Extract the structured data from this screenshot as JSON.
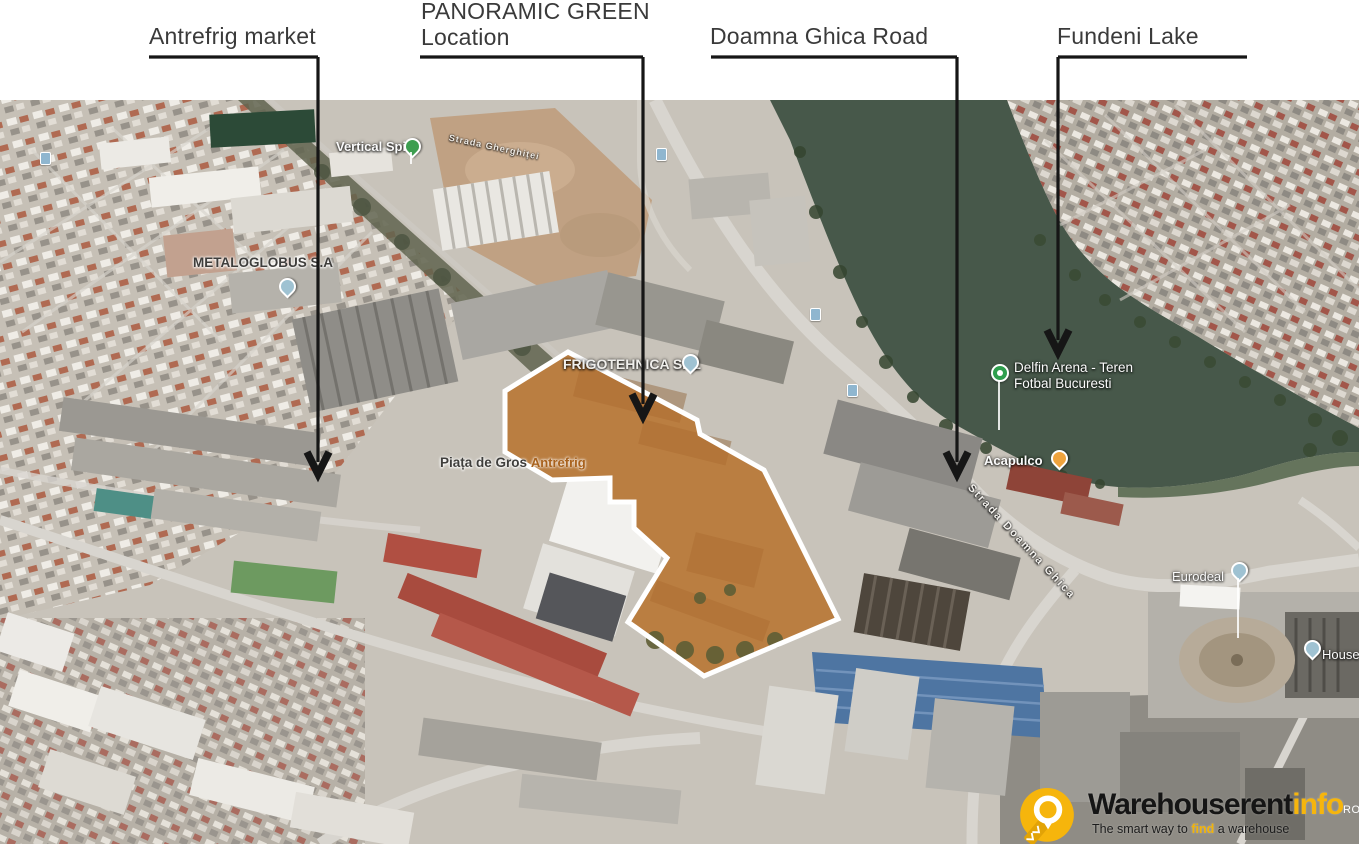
{
  "callouts": {
    "antrefrig": {
      "label": "Antrefrig market"
    },
    "panoramic": {
      "line1": "PANORAMIC GREEN",
      "line2": "Location"
    },
    "doamna": {
      "label": "Doamna Ghica Road"
    },
    "fundeni": {
      "label": "Fundeni Lake"
    }
  },
  "map_labels": {
    "vertical_spirit": "Vertical Spirit",
    "strada_gherghitei": "Strada Gherghiței",
    "metaloglobus": "METALOGLOBUS S.A",
    "frigotehnica": "FRIGOTEHNICA SRL",
    "piata_de_gros": "Piața de Gros",
    "antrefrig_poi": "Antrefrig",
    "delfin_line1": "Delfin Arena - Teren",
    "delfin_line2": "Fotbal Bucuresti",
    "acapulco": "Acapulco",
    "strada_doamna_ghica": "Strada Doamna Ghica",
    "eurodeal": "Eurodeal",
    "house": "House"
  },
  "watermark": {
    "brand": "Warehouserent",
    "brand_suffix": "info",
    "country": "RO",
    "tagline_pre": "The smart way to ",
    "tagline_highlight": "find",
    "tagline_post": " a warehouse"
  },
  "colors": {
    "site_highlight_fill": "#c4732c",
    "site_highlight_border": "#ffffff",
    "lake": "#47584a",
    "annotation_line": "#161616",
    "brand_yellow": "#f6b50c"
  }
}
